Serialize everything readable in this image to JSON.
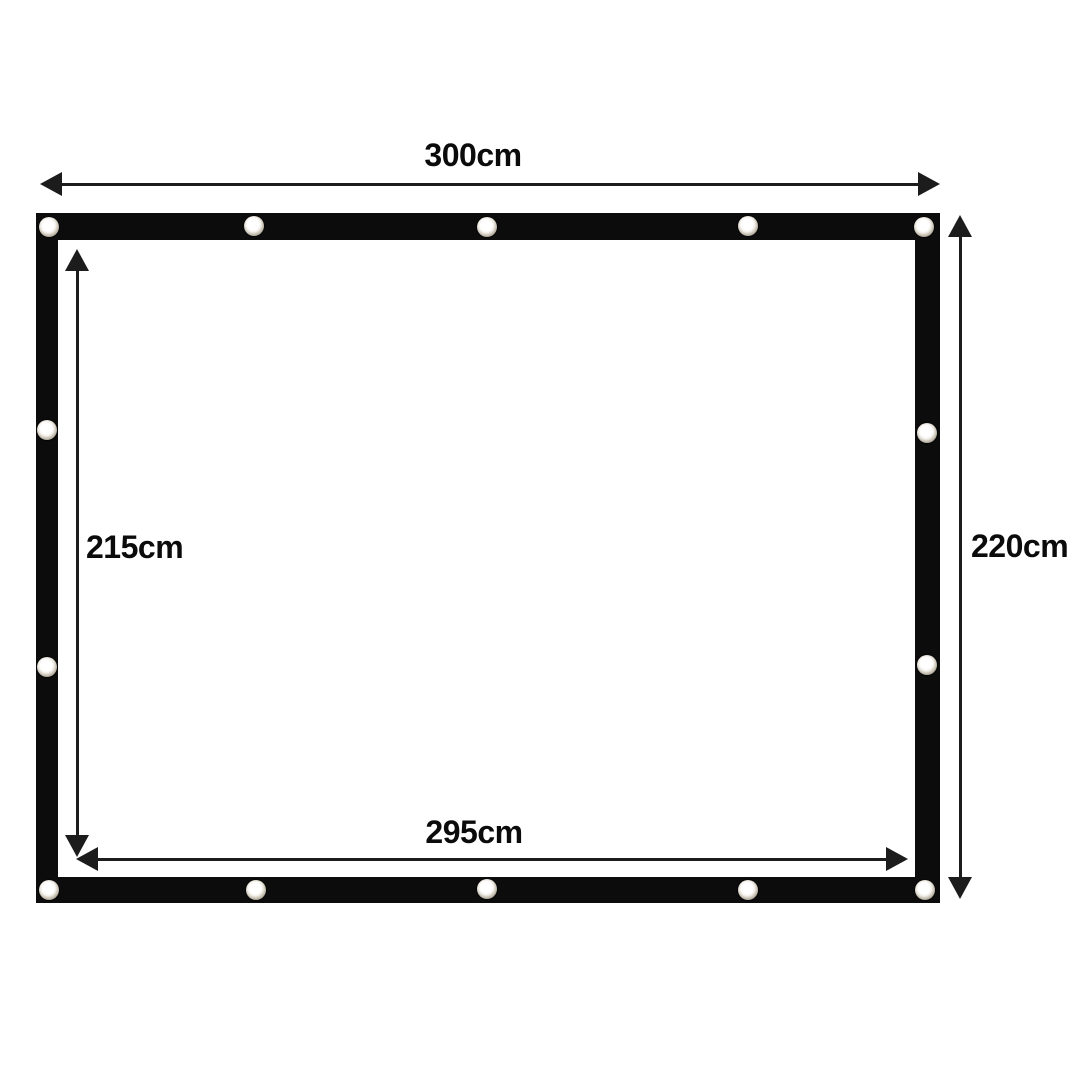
{
  "diagram": {
    "description": "Dimension diagram of a black tarp / screen with 14 metal grommets",
    "dimensions": {
      "outer_width": {
        "label": "300cm"
      },
      "outer_height": {
        "label": "220cm"
      },
      "inner_height": {
        "label": "215cm"
      },
      "inner_width": {
        "label": "295cm"
      }
    },
    "grommet_count": 14,
    "colors": {
      "background": "#ffffff",
      "frame": "#0c0c0c",
      "arrow": "#1c1c1c",
      "grommet_ring": "#cfc9bc",
      "grommet_center": "#ffffff",
      "label_text": "#0b0b0b"
    }
  }
}
